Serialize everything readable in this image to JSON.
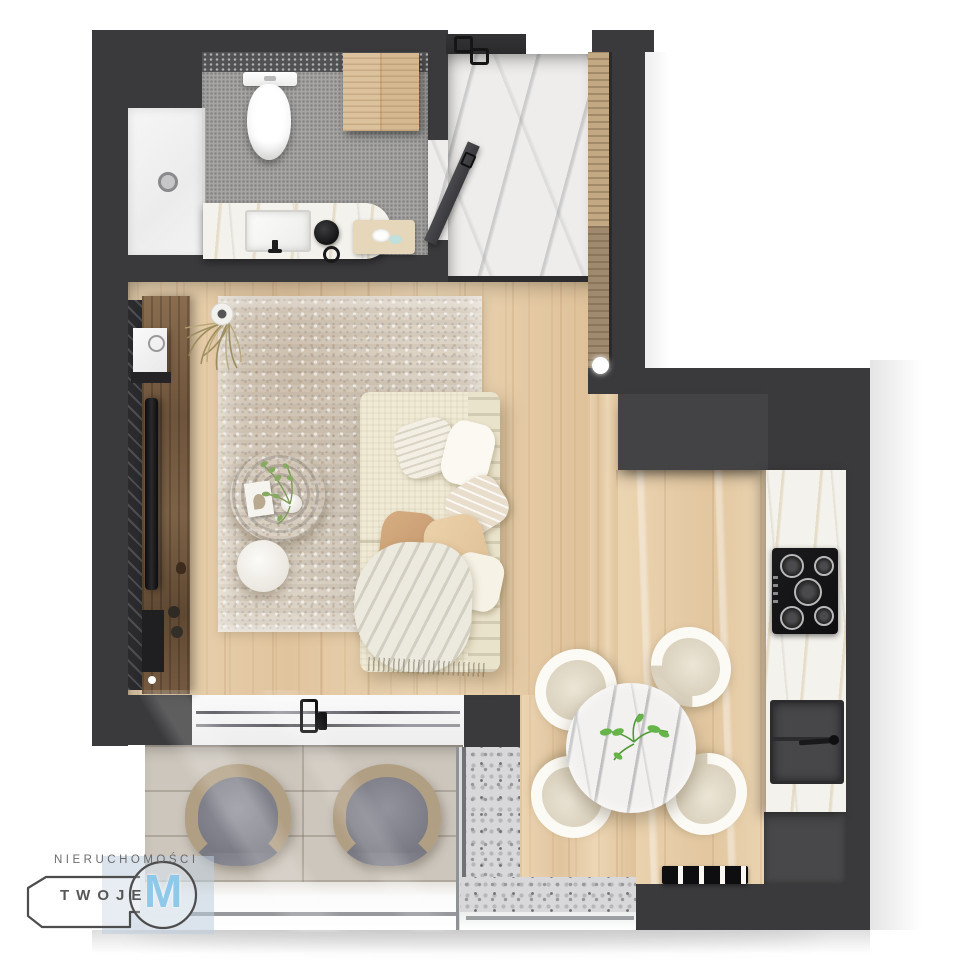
{
  "logo": {
    "company_line": "NIERUCHOMOŚCI",
    "brand_word": "TWOJE",
    "monogram": "M",
    "text_color": "#6b6b6b",
    "monogram_color": "#8ec9e9",
    "badge_tint": "#c6d3e0",
    "key_outline_color": "#4d4d4d"
  },
  "palette": {
    "background": "#ffffff",
    "wall_dark": "#3a3a3c",
    "wall_inner": "#434345",
    "wood_floor": "#e6cda8",
    "rug_base": "#dcd3c5",
    "marble_white": "#eeedeb",
    "counter_marble": "#f4f2ec",
    "mosaic_gray": "#a6a5a3",
    "balcony_tile": "#cdc6bc",
    "terrazzo": "#d8d8da",
    "sofa_cream": "#f0ead6",
    "walnut_dark": "#6a5139",
    "cushion_gray": "#85858d",
    "wicker_tan": "#b19f84",
    "appliance_black": "#141416"
  },
  "scene": {
    "type": "apartment-floor-plan-3d-top-view",
    "rooms": [
      "bathroom",
      "entrance-hall",
      "living-room",
      "kitchen",
      "dining-area",
      "balcony",
      "terrace"
    ],
    "furniture": [
      "shower-tray",
      "toilet",
      "vanity-with-sink",
      "bathroom-cabinet",
      "wardrobe",
      "sofa-with-pillows-and-throw",
      "area-rug",
      "round-coffee-table",
      "round-side-table",
      "tv-console",
      "tv",
      "round-dining-table",
      "dining-chairs-x4",
      "kitchen-counter",
      "gas-cooktop",
      "kitchen-sink",
      "balcony-armchairs-x2",
      "radiator",
      "potted-plants"
    ]
  }
}
